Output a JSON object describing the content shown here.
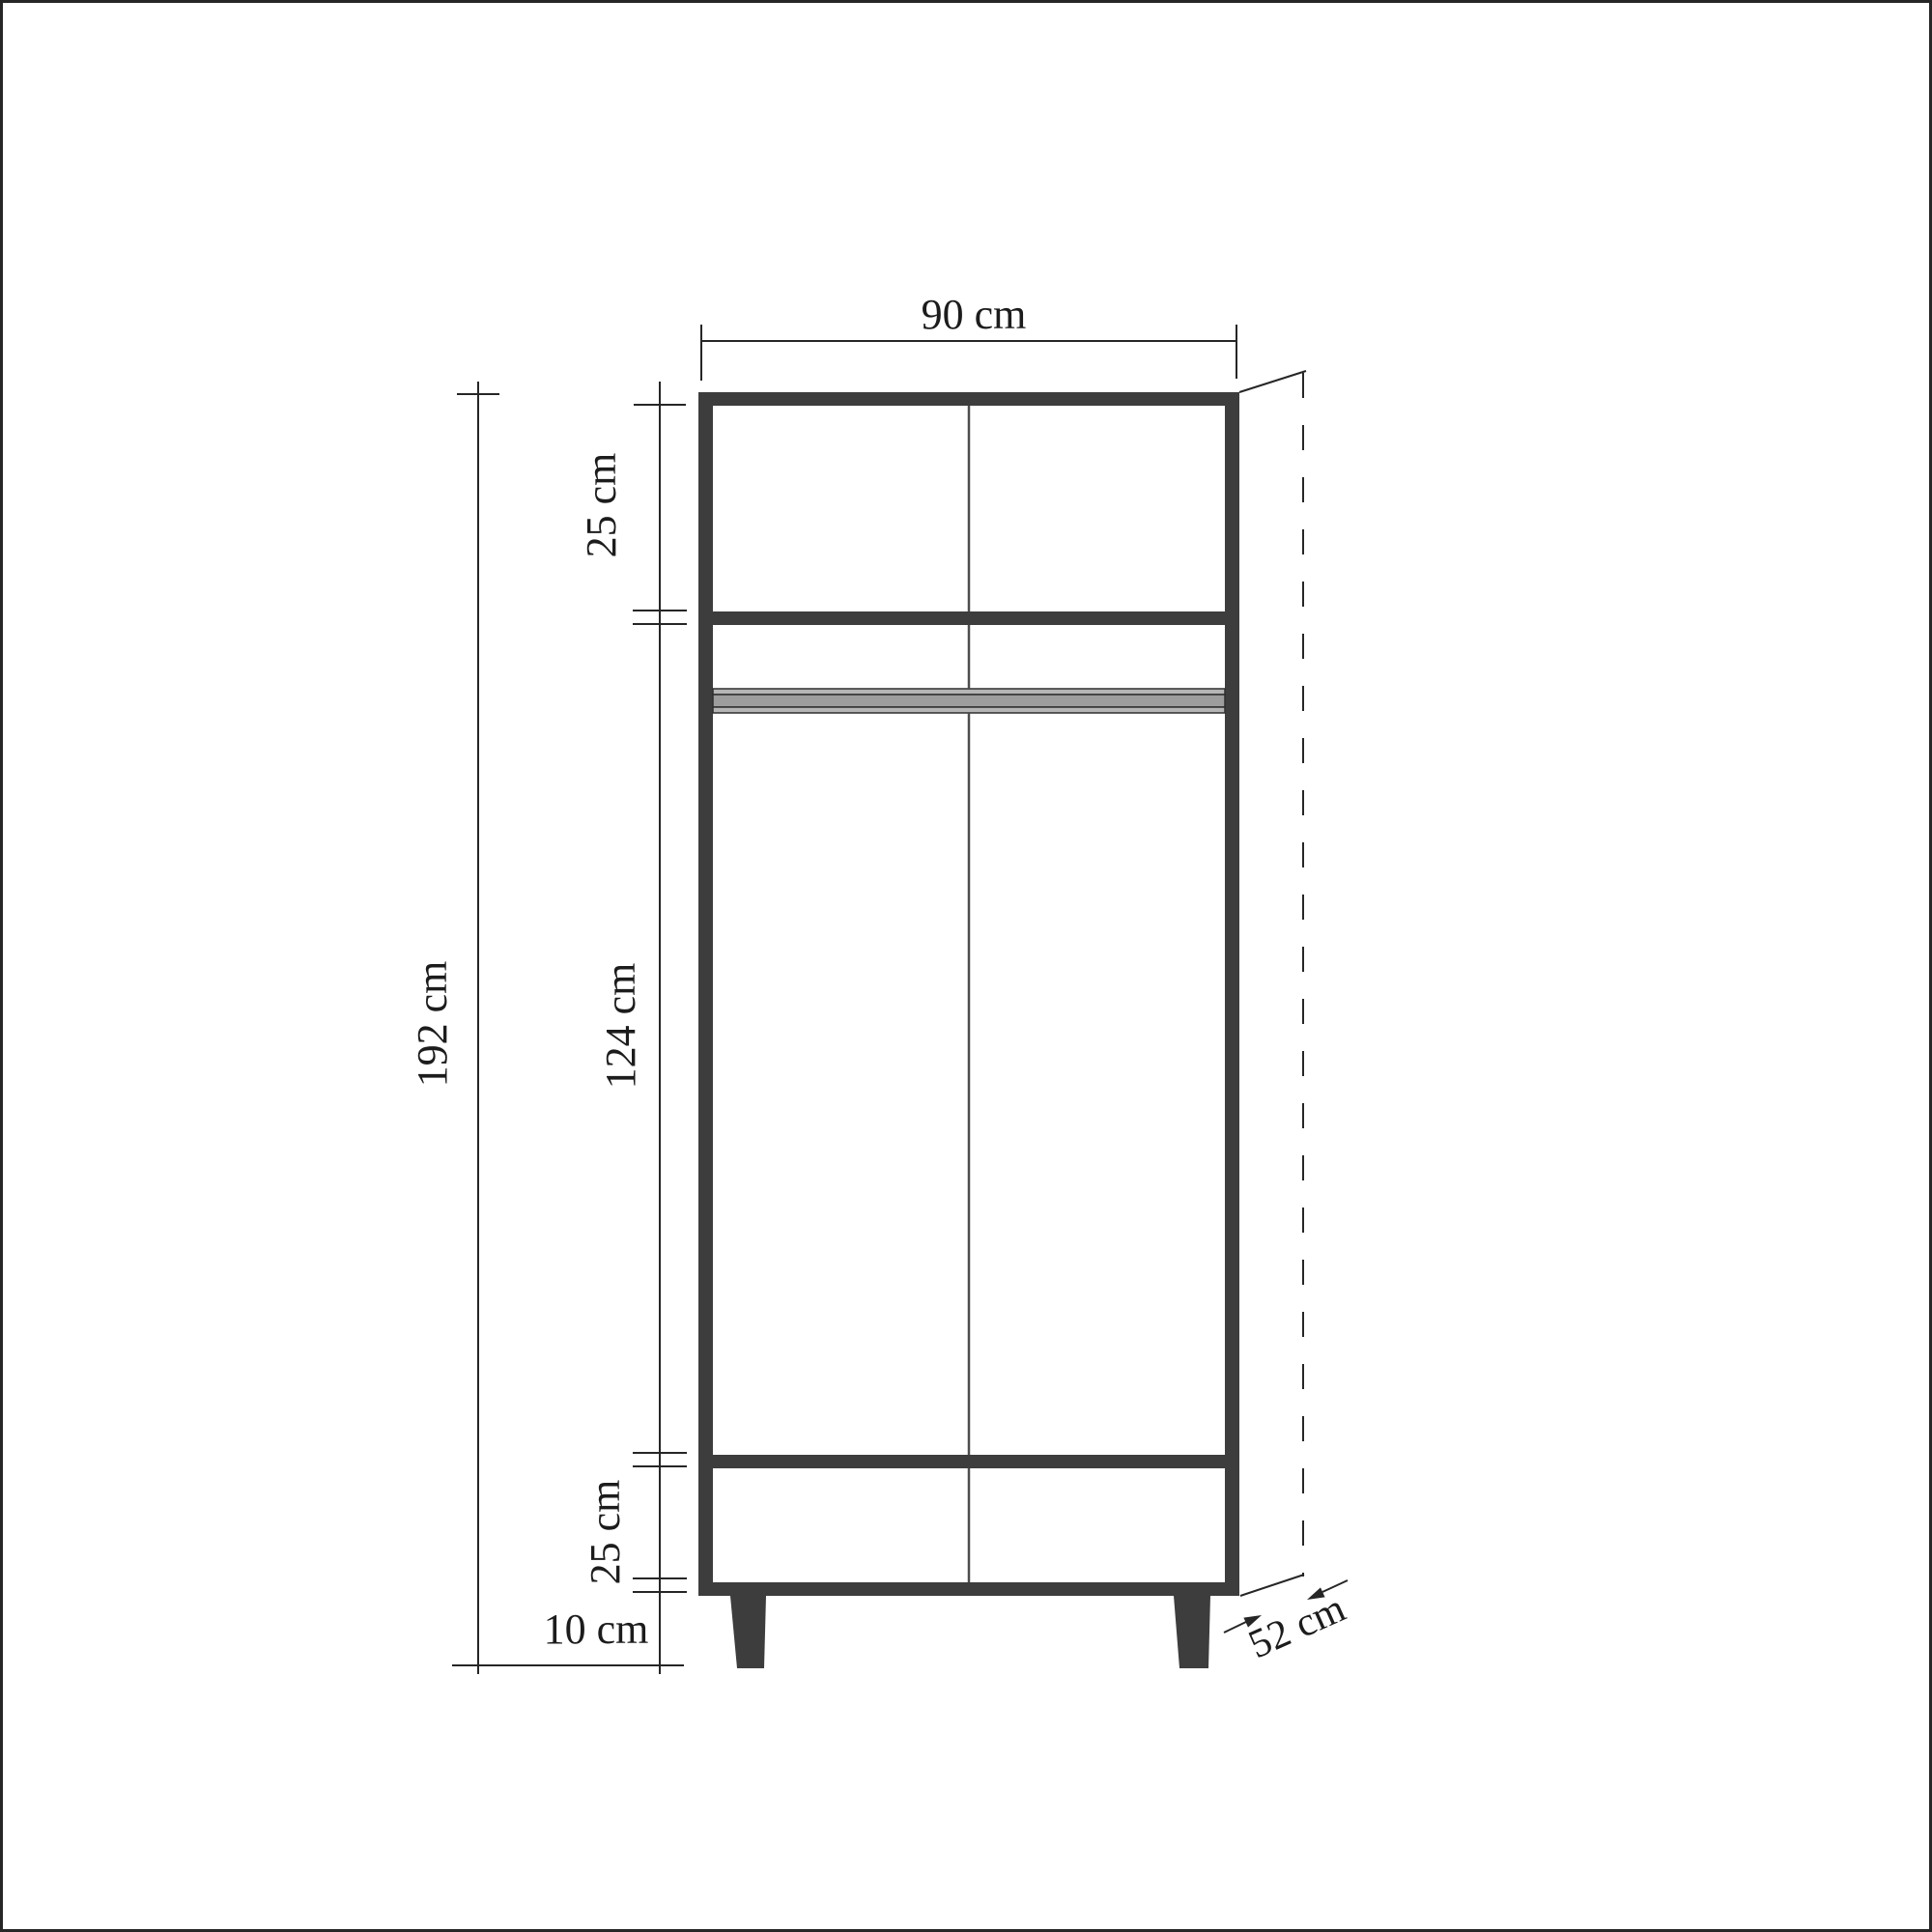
{
  "page": {
    "background_color": "#ffffff",
    "border_color": "#262626"
  },
  "drawing": {
    "kind": "furniture-dimension-diagram",
    "subject": "two-door wardrobe front elevation with depth projection",
    "style": {
      "panel_color": "#3d3d3d",
      "leg_color": "#3d3d3d",
      "line_color": "#262626",
      "door_split_color": "#4d4d4d",
      "rod_light_color": "#b5b5b5",
      "rod_mid_color": "#9d9d9d",
      "text_color": "#1c1c1c"
    },
    "dimensions": {
      "width": {
        "label": "90 cm"
      },
      "total_height": {
        "label": "192 cm"
      },
      "top_section": {
        "label": "25 cm"
      },
      "middle_section": {
        "label": "124 cm"
      },
      "bottom_section": {
        "label": "25 cm"
      },
      "leg_height": {
        "label": "10 cm"
      },
      "depth": {
        "label": "52 cm"
      }
    }
  }
}
